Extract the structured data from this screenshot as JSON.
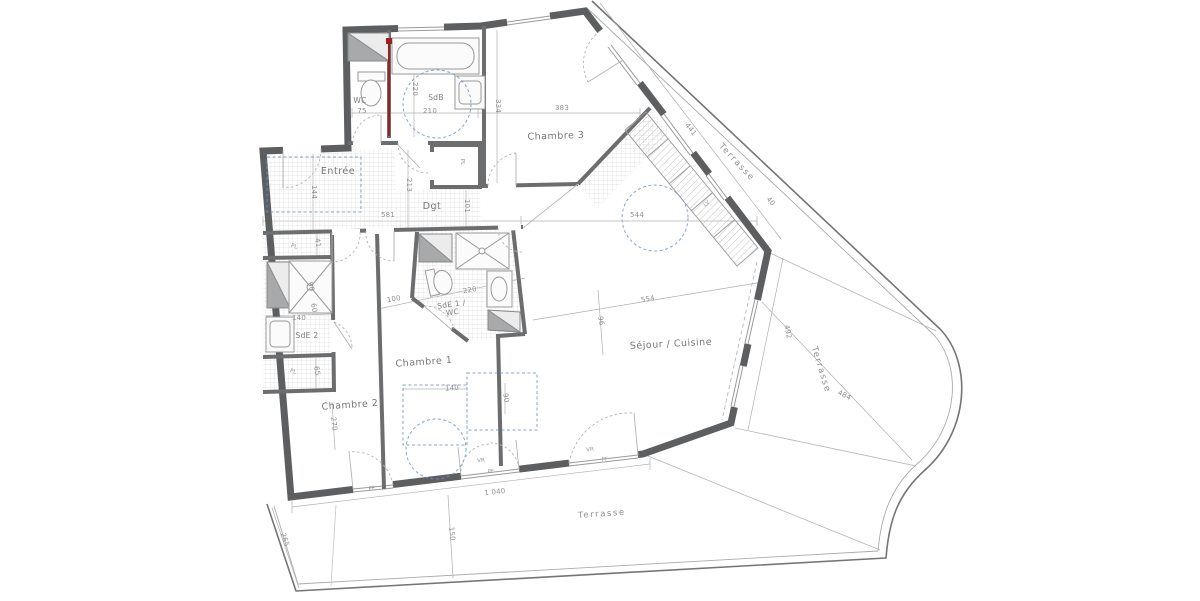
{
  "plan_title": "Appartement T4 avec terrasse - plan d'étage",
  "colors": {
    "wall": "#5c5e60",
    "interior_wall": "#6b6d6f",
    "thin_line": "#9c9c9c",
    "dim_text": "#8f8f8f",
    "room_text": "#73767a",
    "furniture_blue": "#7096cc",
    "section_red": "#9e1f1f",
    "hatch": "#c8c8c8"
  },
  "rooms": [
    {
      "id": "entree",
      "label": "Entrée",
      "x": 338,
      "y": 172,
      "rot": 0,
      "cls": "room"
    },
    {
      "id": "wc",
      "label": "WC",
      "x": 360,
      "y": 101,
      "rot": 0,
      "cls": "small-room"
    },
    {
      "id": "sdb",
      "label": "SdB",
      "x": 436,
      "y": 98,
      "rot": 0,
      "cls": "small-room"
    },
    {
      "id": "chambre-3",
      "label": "Chambre 3",
      "x": 556,
      "y": 137,
      "rot": -2,
      "cls": "room"
    },
    {
      "id": "dgt",
      "label": "Dgt",
      "x": 432,
      "y": 207,
      "rot": 0,
      "cls": "room"
    },
    {
      "id": "pl-dgt",
      "label": "PL",
      "x": 462,
      "y": 162,
      "rot": 90,
      "cls": "tiny"
    },
    {
      "id": "sde1-wc",
      "label": "SdE 1 /\nWC",
      "x": 452,
      "y": 309,
      "rot": -8,
      "cls": "small-room"
    },
    {
      "id": "sde2",
      "label": "SdE 2",
      "x": 307,
      "y": 336,
      "rot": 0,
      "cls": "small-room"
    },
    {
      "id": "pl-left-top",
      "label": "PL",
      "x": 294,
      "y": 247,
      "rot": 16,
      "cls": "tiny"
    },
    {
      "id": "pl-left-bottom",
      "label": "PL",
      "x": 293,
      "y": 372,
      "rot": 16,
      "cls": "tiny"
    },
    {
      "id": "chambre-1",
      "label": "Chambre 1",
      "x": 424,
      "y": 363,
      "rot": -4,
      "cls": "room"
    },
    {
      "id": "chambre-2",
      "label": "Chambre 2",
      "x": 350,
      "y": 406,
      "rot": -4,
      "cls": "room"
    },
    {
      "id": "sejour-cuisine",
      "label": "Séjour / Cuisine",
      "x": 671,
      "y": 345,
      "rot": -3,
      "cls": "room"
    }
  ],
  "terrace_labels": [
    {
      "id": "terrasse-haut",
      "label": "Terrasse",
      "x": 736,
      "y": 163,
      "rot": 47
    },
    {
      "id": "terrasse-droite",
      "label": "Terrasse",
      "x": 820,
      "y": 370,
      "rot": 73
    },
    {
      "id": "terrasse-bas",
      "label": "Terrasse",
      "x": 602,
      "y": 515,
      "rot": -4
    }
  ],
  "dimensions": [
    {
      "value": "75",
      "x": 362,
      "y": 112,
      "rot": 0
    },
    {
      "value": "210",
      "x": 430,
      "y": 112,
      "rot": 0
    },
    {
      "value": "220",
      "x": 414,
      "y": 89,
      "rot": 90
    },
    {
      "value": "334",
      "x": 497,
      "y": 106,
      "rot": 90
    },
    {
      "value": "383",
      "x": 562,
      "y": 109,
      "rot": 0
    },
    {
      "value": "144",
      "x": 313,
      "y": 192,
      "rot": 90
    },
    {
      "value": "213",
      "x": 408,
      "y": 185,
      "rot": 90
    },
    {
      "value": "101",
      "x": 466,
      "y": 206,
      "rot": 90
    },
    {
      "value": "581",
      "x": 388,
      "y": 216,
      "rot": 0
    },
    {
      "value": "544",
      "x": 637,
      "y": 216,
      "rot": 0
    },
    {
      "value": "41",
      "x": 317,
      "y": 243,
      "rot": 80
    },
    {
      "value": "90",
      "x": 310,
      "y": 287,
      "rot": 75
    },
    {
      "value": "60",
      "x": 313,
      "y": 308,
      "rot": 80
    },
    {
      "value": "140",
      "x": 299,
      "y": 319,
      "rot": 0
    },
    {
      "value": "65",
      "x": 316,
      "y": 371,
      "rot": 80
    },
    {
      "value": "100",
      "x": 394,
      "y": 300,
      "rot": -10
    },
    {
      "value": "220",
      "x": 470,
      "y": 291,
      "rot": -10
    },
    {
      "value": "270",
      "x": 333,
      "y": 424,
      "rot": 84
    },
    {
      "value": "140",
      "x": 452,
      "y": 389,
      "rot": -4
    },
    {
      "value": "90",
      "x": 505,
      "y": 398,
      "rot": 80
    },
    {
      "value": "554",
      "x": 648,
      "y": 300,
      "rot": -9
    },
    {
      "value": "96",
      "x": 600,
      "y": 321,
      "rot": 80
    },
    {
      "value": "441",
      "x": 690,
      "y": 130,
      "rot": 52
    },
    {
      "value": "40",
      "x": 770,
      "y": 202,
      "rot": 50
    },
    {
      "value": "492",
      "x": 787,
      "y": 332,
      "rot": 79
    },
    {
      "value": "484",
      "x": 844,
      "y": 396,
      "rot": 26
    },
    {
      "value": "1 040",
      "x": 495,
      "y": 493,
      "rot": -6
    },
    {
      "value": "150",
      "x": 451,
      "y": 534,
      "rot": 84
    },
    {
      "value": "265",
      "x": 284,
      "y": 540,
      "rot": 72
    }
  ],
  "annotations": [
    {
      "label": "LV",
      "x": 707,
      "y": 204,
      "rot": -43
    },
    {
      "label": "PF",
      "x": 372,
      "y": 489,
      "rot": -6
    },
    {
      "label": "PF",
      "x": 491,
      "y": 472,
      "rot": -6
    },
    {
      "label": "PF",
      "x": 605,
      "y": 460,
      "rot": -6
    },
    {
      "label": "VR",
      "x": 481,
      "y": 461,
      "rot": -6
    },
    {
      "label": "VR",
      "x": 590,
      "y": 450,
      "rot": -6
    }
  ]
}
